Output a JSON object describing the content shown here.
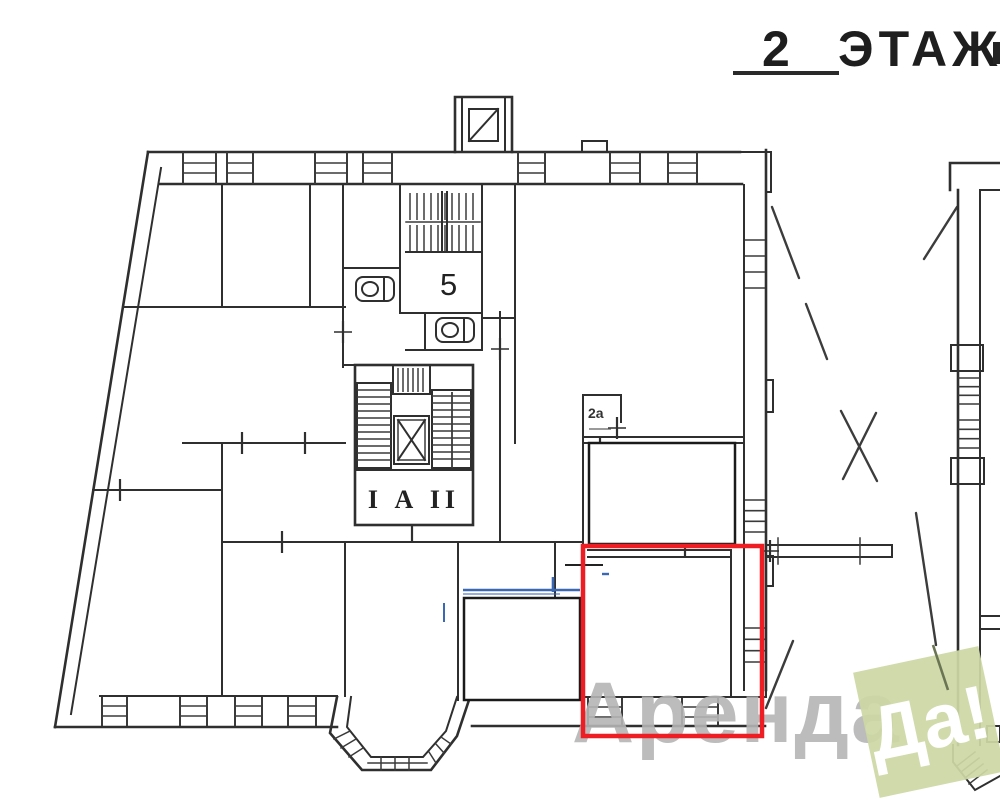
{
  "header": {
    "floor_number": "2",
    "floor_word": "ЭТАЖ"
  },
  "plan": {
    "labels": {
      "staircase": "5",
      "elevator_unit": "I А II",
      "room_2a": "2а"
    },
    "colors": {
      "wall_ink": "#2f2f2f",
      "highlight": "#ee1d23",
      "annotation_blue": "#3b68b5"
    }
  },
  "watermark": {
    "brand_word": "Аренда",
    "badge_word": "Да!",
    "badge_color": "#ccd7a4",
    "brand_text_color": "#b5b5b5"
  }
}
